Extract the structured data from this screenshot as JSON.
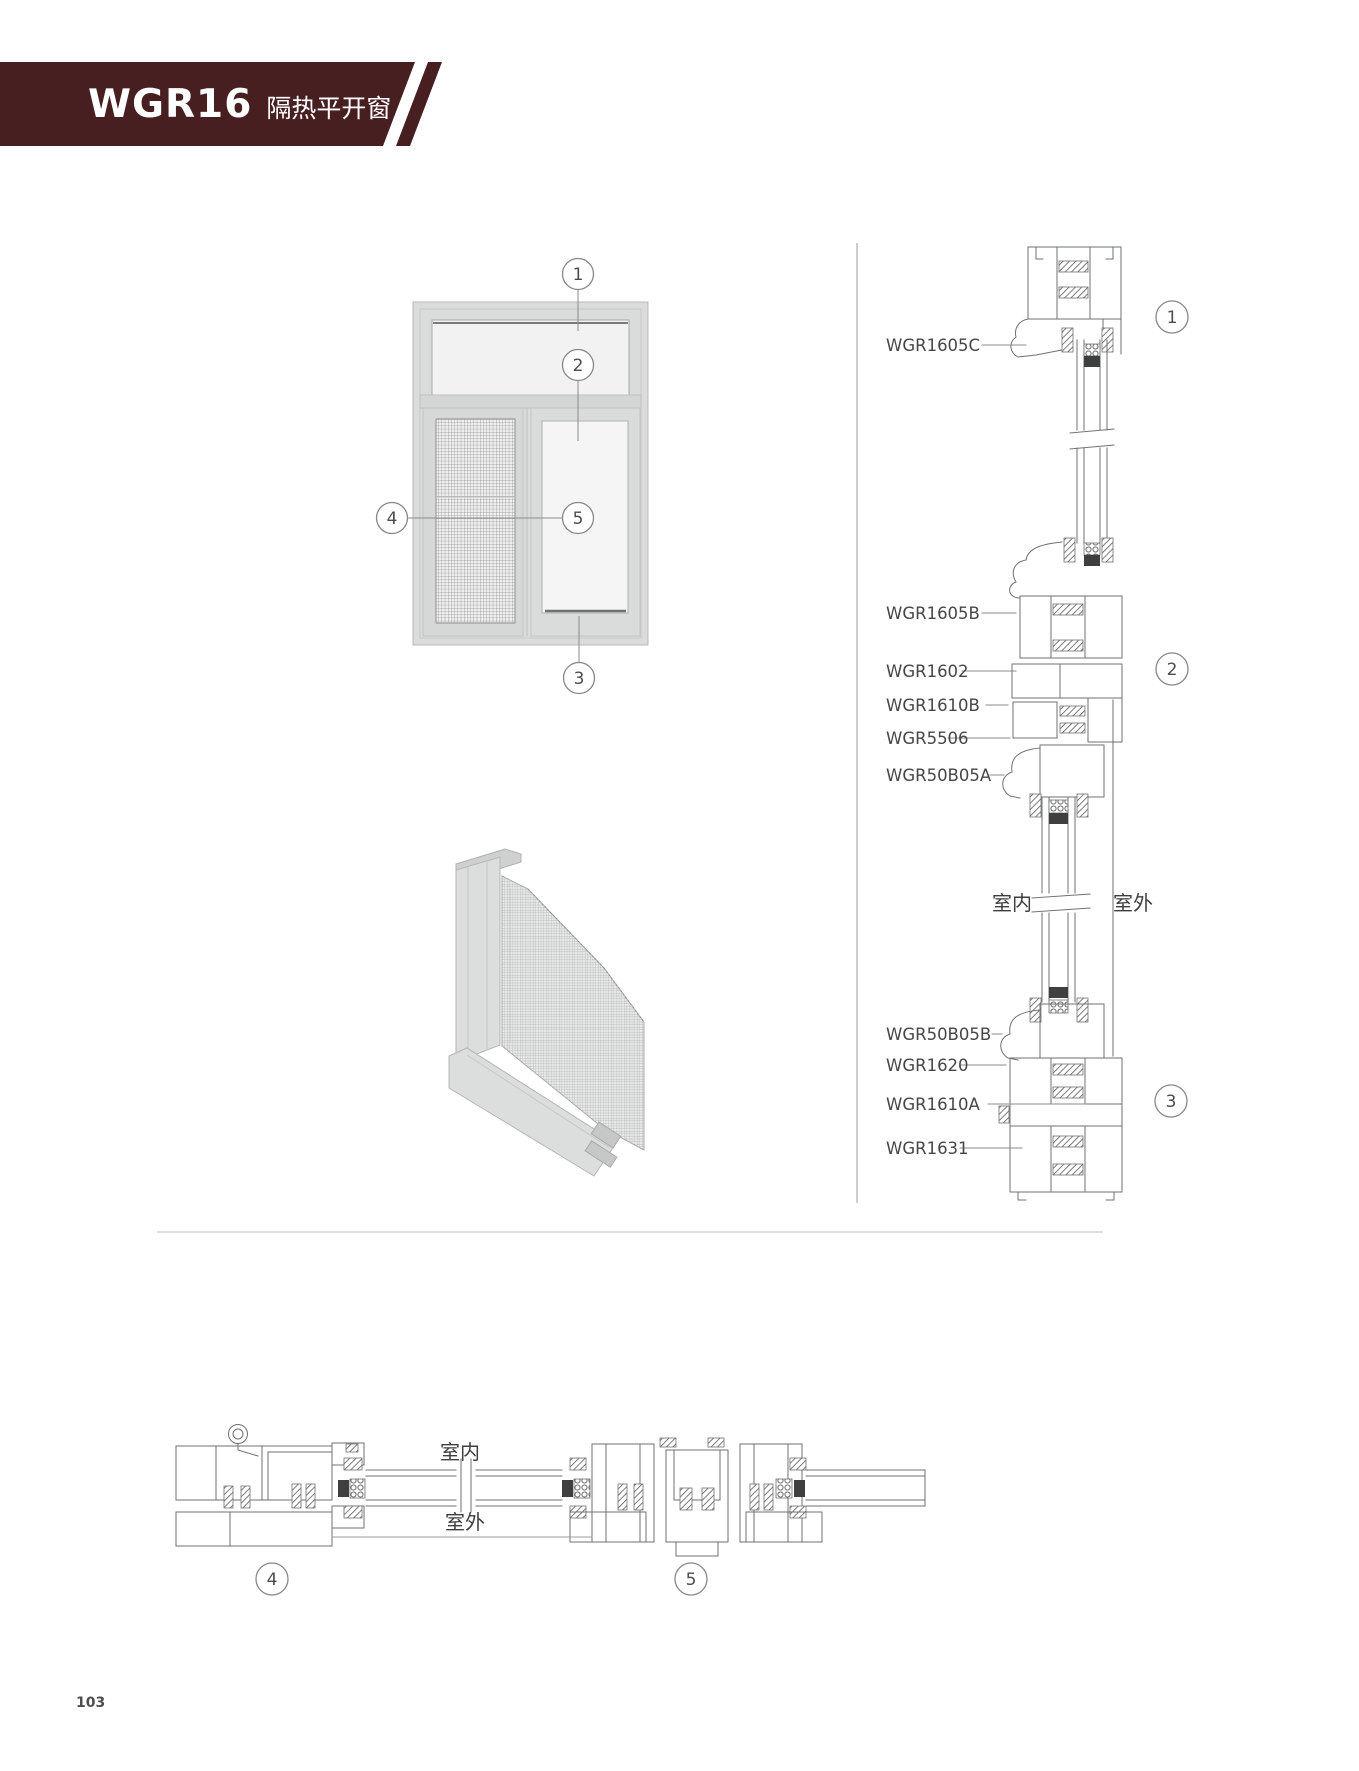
{
  "header": {
    "model": "WGR16",
    "series_name": "隔热平开窗",
    "banner_color": "#481f21"
  },
  "elevation": {
    "callouts": {
      "c1": "1",
      "c2": "2",
      "c3": "3",
      "c4": "4",
      "c5": "5"
    }
  },
  "vertical_section": {
    "parts": [
      "WGR1605C",
      "WGR1605B",
      "WGR1602",
      "WGR1610B",
      "WGR5506",
      "WGR50B05A",
      "WGR50B05B",
      "WGR1620",
      "WGR1610A",
      "WGR1631"
    ],
    "indoor_label": "室内",
    "outdoor_label": "室外",
    "callouts": {
      "c1": "1",
      "c2": "2",
      "c3": "3"
    }
  },
  "horizontal_section": {
    "indoor_label": "室内",
    "outdoor_label": "室外",
    "callouts": {
      "c4": "4",
      "c5": "5"
    }
  },
  "footer": {
    "page_number": "103"
  }
}
